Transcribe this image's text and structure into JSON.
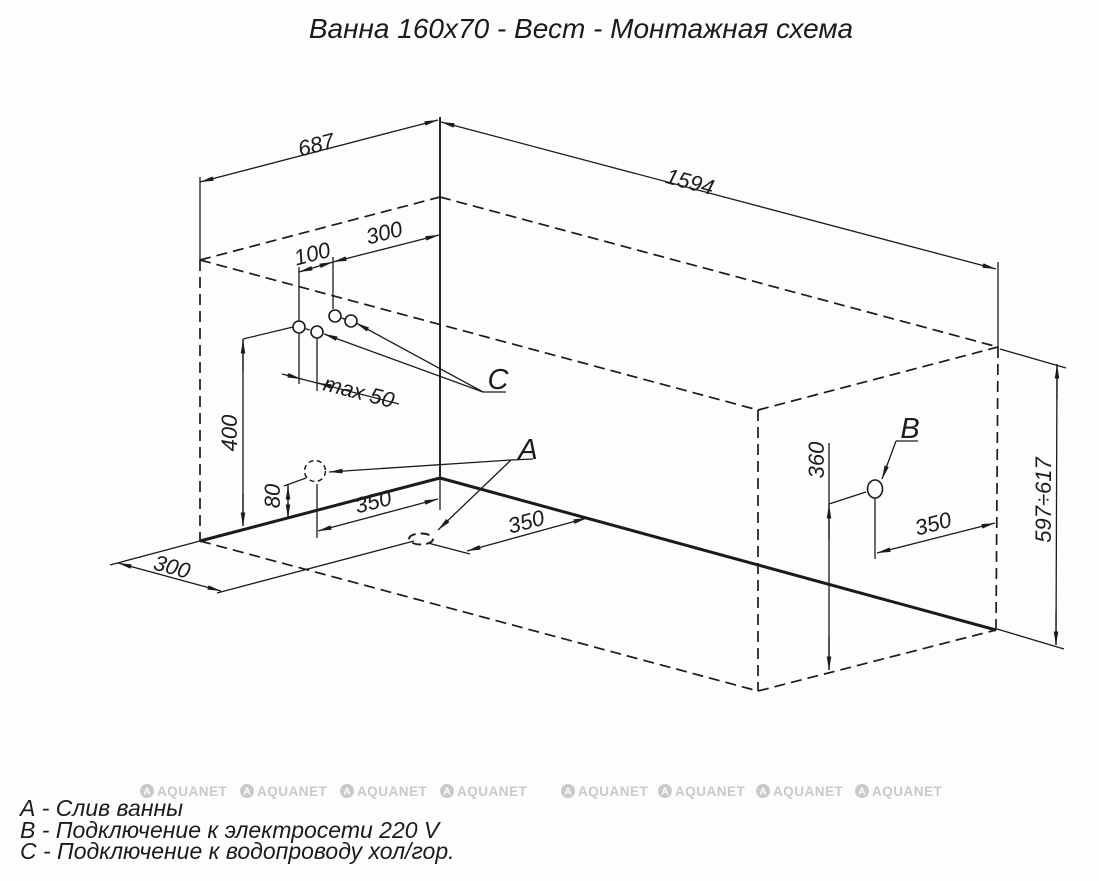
{
  "title": "Ванна 160x70 - Вест - Монтажная схема",
  "callouts": {
    "a": "A",
    "b": "B",
    "c": "C"
  },
  "dims": {
    "top_width": "687",
    "top_length": "1594",
    "c_pair_spacing": "100",
    "c_offset_from_corner": "300",
    "c_max_spread": "max 50",
    "c_height": "400",
    "wall_drain_height": "80",
    "wall_drain_offset": "350",
    "floor_drain_offset_width": "350",
    "floor_drain_offset_length": "300",
    "b_height": "360",
    "b_offset": "350",
    "overall_height": "597÷617"
  },
  "legend": {
    "a": "А - Слив ванны",
    "b": "В - Подключение к электросети 220 V",
    "c": "С - Подключение к водопроводу хол/гор."
  },
  "watermark": {
    "logo_letter": "A",
    "text": "AQUANET"
  }
}
